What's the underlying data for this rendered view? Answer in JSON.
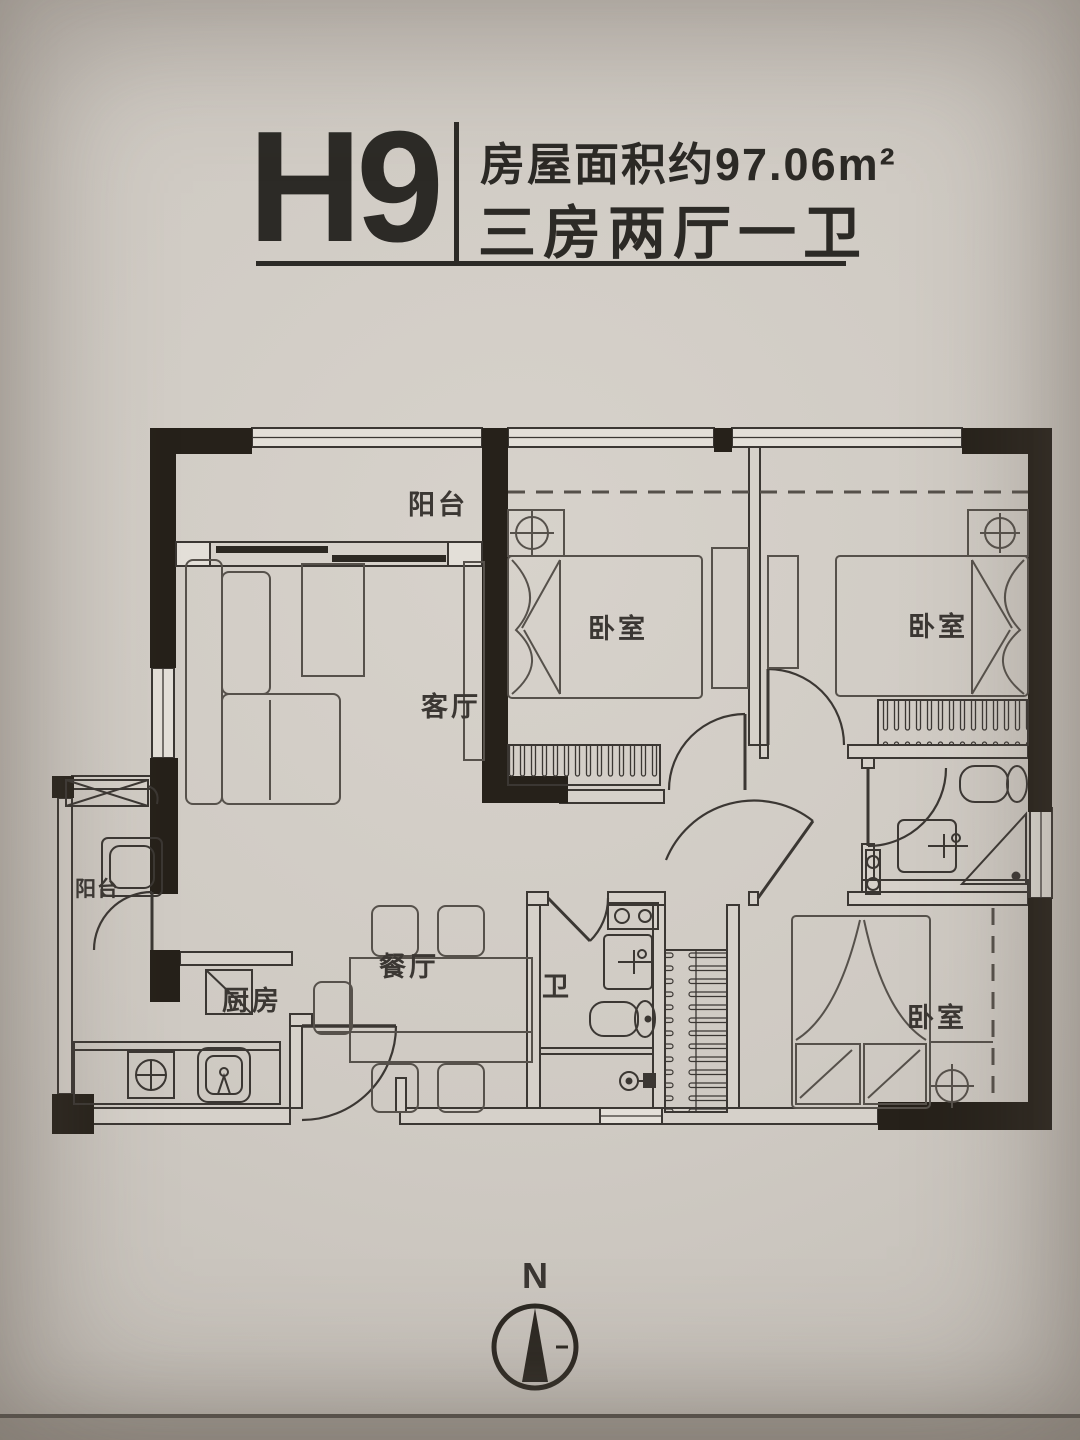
{
  "header": {
    "unit_code": "H9",
    "area_text": "房屋面积约97.06m²",
    "layout_text": "三房两厅一卫"
  },
  "rooms": {
    "balcony_top": "阳台",
    "living_room": "客厅",
    "bedroom": "卧室",
    "dining_room": "餐厅",
    "kitchen": "厨房",
    "bathroom": "卫",
    "balcony_side": "阳台"
  },
  "compass": {
    "north_label": "N"
  },
  "colors": {
    "paper": "#cfcac3",
    "ink": "#3b3733",
    "wall_black": "#26211a",
    "header_text": "#2c2a26"
  }
}
